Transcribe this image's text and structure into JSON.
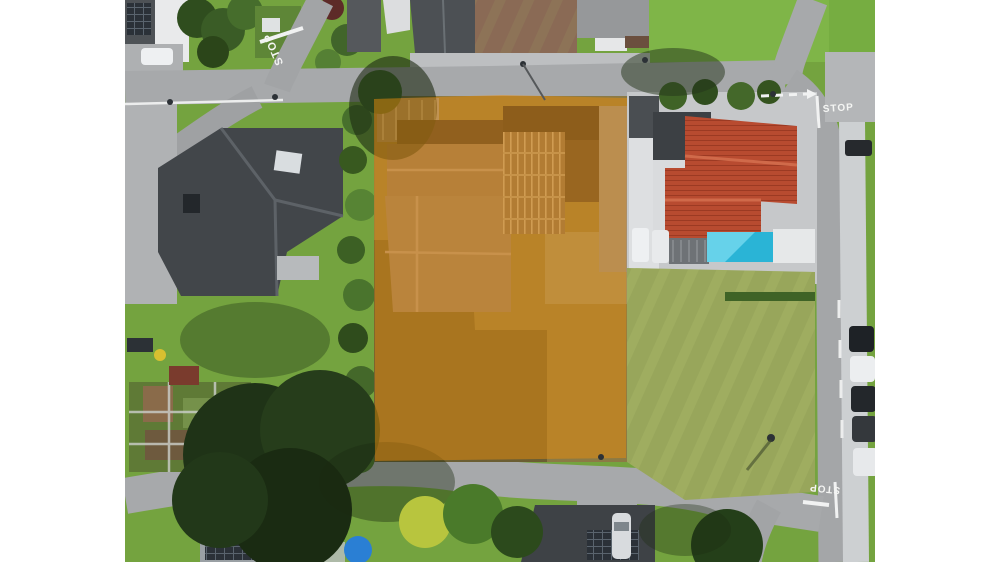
{
  "image": {
    "kind": "aerial drone photograph",
    "description": "Top-down aerial view of a residential neighborhood with a building plot highlighted by a semi-transparent orange overlay",
    "letterbox_color": "#ffffff"
  },
  "plot_overlay": {
    "label": "highlighted building plot",
    "color": "#e88c0c",
    "opacity": 0.5
  },
  "road_markings": {
    "stop_top_left": "STOP",
    "stop_top_right": "STOP",
    "stop_bottom_right": "STOP"
  },
  "palette": {
    "asphalt": "#a7a9ab",
    "lawn_green": "#74a33f",
    "meadow_green": "#98a65b",
    "charcoal_roof": "#42464a",
    "red_tile_roof": "#b84b30",
    "pool_blue": "#2ab4d6",
    "dry_meadow_highlighted": "#a87a28"
  }
}
